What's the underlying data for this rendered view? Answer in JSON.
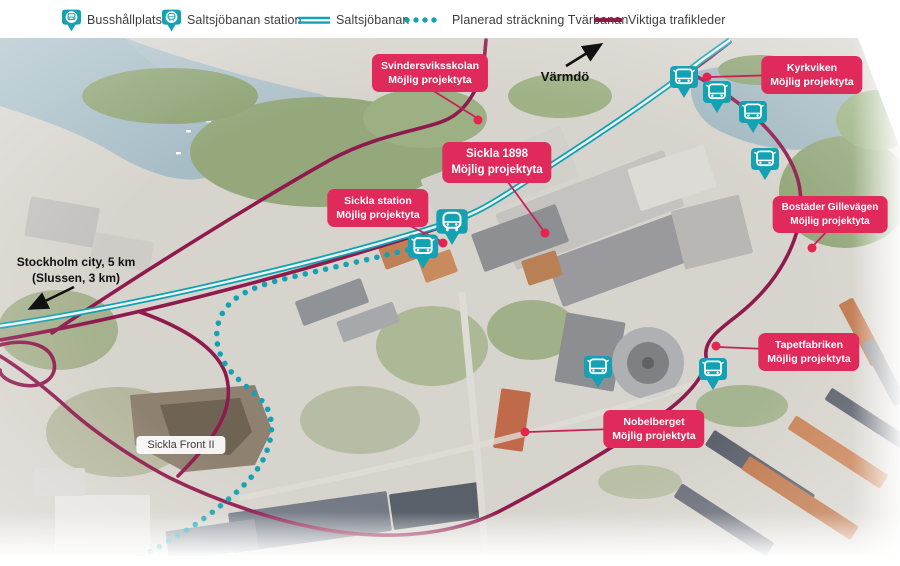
{
  "legend": {
    "items": [
      {
        "label": "Busshållplats",
        "icon": "bus-pin-icon"
      },
      {
        "label": "Saltsjöbanan station",
        "icon": "train-pin-icon"
      },
      {
        "label": "Saltsjöbanan",
        "icon": "double-teal-line"
      },
      {
        "label": "Planerad sträckning Tvärbanan",
        "icon": "dotted-teal-line"
      },
      {
        "label": "Viktiga trafikleder",
        "icon": "solid-crimson-line"
      }
    ]
  },
  "map": {
    "callouts": [
      {
        "id": "svindersviksskolan",
        "line1": "Svindersviksskolan",
        "line2": "Möjlig projektyta"
      },
      {
        "id": "kyrkviken",
        "line1": "Kyrkviken",
        "line2": "Möjlig projektyta"
      },
      {
        "id": "sickla-1898",
        "line1": "Sickla 1898",
        "line2": "Möjlig projektyta"
      },
      {
        "id": "sickla-station",
        "line1": "Sickla station",
        "line2": "Möjlig projektyta"
      },
      {
        "id": "bostader-gillevagen",
        "line1": "Bostäder Gillevägen",
        "line2": "Möjlig projektyta"
      },
      {
        "id": "tapetfabriken",
        "line1": "Tapetfabriken",
        "line2": "Möjlig projektyta"
      },
      {
        "id": "nobelberget",
        "line1": "Nobelberget",
        "line2": "Möjlig projektyta"
      }
    ],
    "area_label": "Sickla Front II",
    "direction_labels": {
      "varmdo": "Värmdö",
      "stockholm_line1": "Stockholm city, 5 km",
      "stockholm_line2": "(Slussen, 3 km)"
    }
  },
  "colors": {
    "pin_teal": "#14a1b3",
    "callout_red": "#e12a5c",
    "major_road_crimson": "#8f1a4d",
    "leader_dot_red": "#e4254e"
  }
}
